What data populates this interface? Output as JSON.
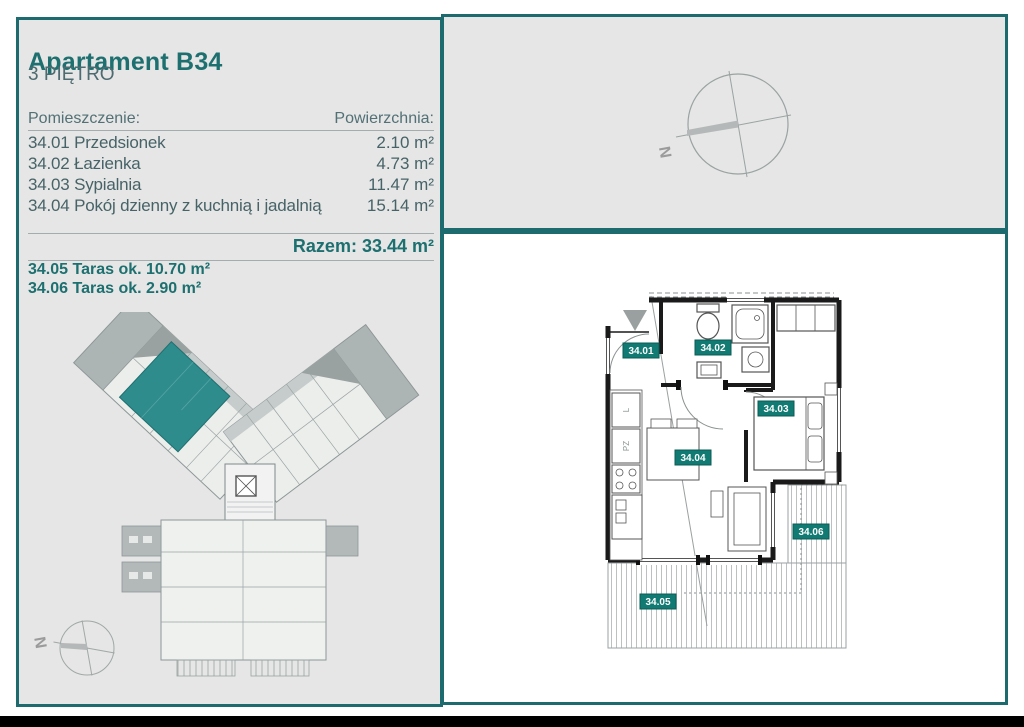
{
  "header": {
    "title": "Apartament B34",
    "floor": "3 PIĘTRO"
  },
  "rooms": {
    "header_name": "Pomieszczenie:",
    "header_area": "Powierzchnia:",
    "rows": [
      {
        "label": "34.01 Przedsionek",
        "area": "2.10 m²"
      },
      {
        "label": "34.02 Łazienka",
        "area": "4.73 m²"
      },
      {
        "label": "34.03 Sypialnia",
        "area": "11.47 m²"
      },
      {
        "label": "34.04 Pokój dzienny z kuchnią i jadalnią",
        "area": "15.14 m²"
      }
    ],
    "total": "Razem: 33.44 m²"
  },
  "terraces": [
    {
      "label": "34.05 Taras ok. 10.70 m²"
    },
    {
      "label": "34.06 Taras ok. 2.90 m²"
    }
  ],
  "compass": {
    "north": "N"
  },
  "floorplan": {
    "badges": {
      "b01": "34.01",
      "b02": "34.02",
      "b03": "34.03",
      "b04": "34.04",
      "b05": "34.05",
      "b06": "34.06"
    },
    "kitchen": {
      "fridge": "L",
      "dishwasher": "PZ"
    }
  },
  "colors": {
    "teal_border": "#1d6b6e",
    "teal_text": "#1d6f70",
    "body_text": "#4d6b70",
    "badge_bg": "#117a72",
    "panel_bg": "#e5e6e5",
    "highlight_unit": "#2e8c8c",
    "bottom_bar": "#000000"
  }
}
